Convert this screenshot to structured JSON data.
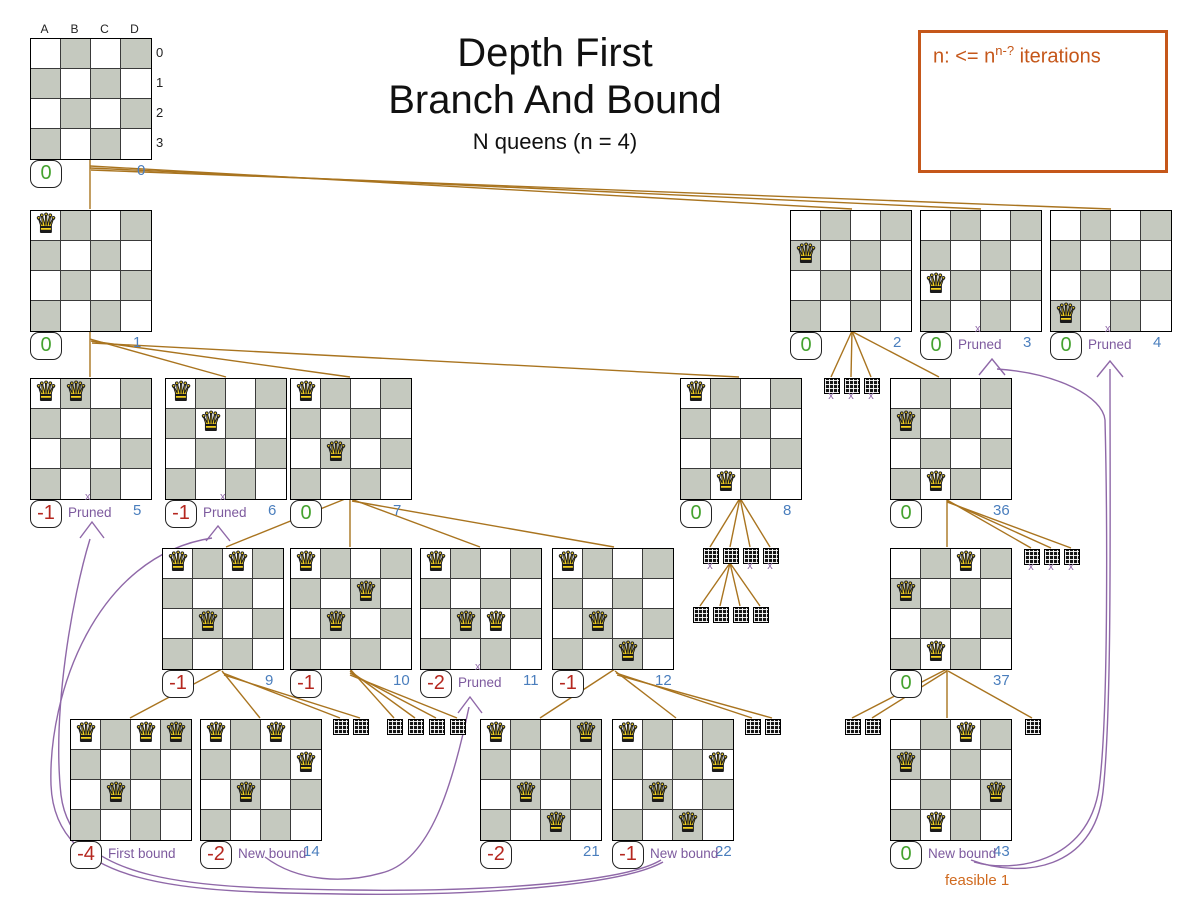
{
  "page": {
    "title_line1": "Depth First",
    "title_line2": "Branch And Bound",
    "subtitle": "N queens (n = 4)"
  },
  "note": {
    "prefix": "n: <= n",
    "superscript": "n-?",
    "suffix": " iterations"
  },
  "board_labels": {
    "columns": [
      "A",
      "B",
      "C",
      "D"
    ],
    "rows": [
      "0",
      "1",
      "2",
      "3"
    ]
  },
  "icons": {
    "queen_glyph": "♛",
    "prune_mark": "x"
  },
  "labels": {
    "pruned": "Pruned",
    "first_bound": "First bound",
    "new_bound": "New bound",
    "feasible": "feasible 1"
  },
  "colors": {
    "edge": "#a9741f",
    "purple": "#8f68a8",
    "label_purple": "#7d5a9e",
    "index_blue": "#4a7ebd",
    "score_green": "#44a22e",
    "score_red": "#b5271f",
    "orange": "#c5571a",
    "feasible_orange": "#d06a1f",
    "dark_cell": "#c5c9bf"
  },
  "nodes": [
    {
      "index": "0",
      "x": 30,
      "y": 38,
      "queens": [],
      "score": "0",
      "state": "good",
      "root": true,
      "index_offset": 107
    },
    {
      "index": "1",
      "x": 30,
      "y": 210,
      "queens": [
        [
          0,
          0
        ]
      ],
      "score": "0",
      "state": "good"
    },
    {
      "index": "2",
      "x": 790,
      "y": 210,
      "queens": [
        [
          0,
          1
        ]
      ],
      "score": "0",
      "state": "good"
    },
    {
      "index": "3",
      "x": 920,
      "y": 210,
      "queens": [
        [
          0,
          2
        ]
      ],
      "score": "0",
      "state": "good",
      "tag": "Pruned",
      "tag_x": true
    },
    {
      "index": "4",
      "x": 1050,
      "y": 210,
      "queens": [
        [
          0,
          3
        ]
      ],
      "score": "0",
      "state": "good",
      "tag": "Pruned",
      "tag_x": true
    },
    {
      "index": "5",
      "x": 30,
      "y": 378,
      "queens": [
        [
          0,
          0
        ],
        [
          1,
          0
        ]
      ],
      "score": "-1",
      "state": "bad",
      "tag": "Pruned",
      "tag_x": true
    },
    {
      "index": "6",
      "x": 165,
      "y": 378,
      "queens": [
        [
          0,
          0
        ],
        [
          1,
          1
        ]
      ],
      "score": "-1",
      "state": "bad",
      "tag": "Pruned",
      "tag_x": true
    },
    {
      "index": "7",
      "x": 290,
      "y": 378,
      "queens": [
        [
          0,
          0
        ],
        [
          1,
          2
        ]
      ],
      "score": "0",
      "state": "good"
    },
    {
      "index": "8",
      "x": 680,
      "y": 378,
      "queens": [
        [
          0,
          0
        ],
        [
          1,
          3
        ]
      ],
      "score": "0",
      "state": "good"
    },
    {
      "index": "36",
      "x": 890,
      "y": 378,
      "queens": [
        [
          0,
          1
        ],
        [
          1,
          3
        ]
      ],
      "score": "0",
      "state": "good"
    },
    {
      "index": "9",
      "x": 162,
      "y": 548,
      "queens": [
        [
          0,
          0
        ],
        [
          2,
          0
        ],
        [
          1,
          2
        ]
      ],
      "score": "-1",
      "state": "bad"
    },
    {
      "index": "10",
      "x": 290,
      "y": 548,
      "queens": [
        [
          0,
          0
        ],
        [
          2,
          1
        ],
        [
          1,
          2
        ]
      ],
      "score": "-1",
      "state": "bad"
    },
    {
      "index": "11",
      "x": 420,
      "y": 548,
      "queens": [
        [
          0,
          0
        ],
        [
          1,
          2
        ],
        [
          2,
          2
        ]
      ],
      "score": "-2",
      "state": "bad",
      "tag": "Pruned",
      "tag_x": true
    },
    {
      "index": "12",
      "x": 552,
      "y": 548,
      "queens": [
        [
          0,
          0
        ],
        [
          1,
          2
        ],
        [
          2,
          3
        ]
      ],
      "score": "-1",
      "state": "bad"
    },
    {
      "index": "37",
      "x": 890,
      "y": 548,
      "queens": [
        [
          2,
          0
        ],
        [
          0,
          1
        ],
        [
          1,
          3
        ]
      ],
      "score": "0",
      "state": "good"
    },
    {
      "index": "13",
      "x": 70,
      "y": 719,
      "queens": [
        [
          0,
          0
        ],
        [
          2,
          0
        ],
        [
          3,
          0
        ],
        [
          1,
          2
        ]
      ],
      "score": "-4",
      "state": "bad",
      "tag": "First bound",
      "index_offset": 135
    },
    {
      "index": "14",
      "x": 200,
      "y": 719,
      "queens": [
        [
          0,
          0
        ],
        [
          2,
          0
        ],
        [
          3,
          1
        ],
        [
          1,
          2
        ]
      ],
      "score": "-2",
      "state": "bad",
      "tag": "New bound"
    },
    {
      "index": "21",
      "x": 480,
      "y": 719,
      "queens": [
        [
          0,
          0
        ],
        [
          3,
          0
        ],
        [
          1,
          2
        ],
        [
          2,
          3
        ]
      ],
      "score": "-2",
      "state": "bad"
    },
    {
      "index": "22",
      "x": 612,
      "y": 719,
      "queens": [
        [
          0,
          0
        ],
        [
          3,
          1
        ],
        [
          1,
          2
        ],
        [
          2,
          3
        ]
      ],
      "score": "-1",
      "state": "bad",
      "tag": "New bound"
    },
    {
      "index": "43",
      "x": 890,
      "y": 719,
      "queens": [
        [
          2,
          0
        ],
        [
          0,
          1
        ],
        [
          3,
          2
        ],
        [
          1,
          3
        ]
      ],
      "score": "0",
      "state": "good",
      "tag": "New bound",
      "tag2": "feasible 1"
    }
  ],
  "mini_nodes": [
    {
      "x": 824,
      "y": 378,
      "x_mark": true
    },
    {
      "x": 844,
      "y": 378,
      "x_mark": true
    },
    {
      "x": 864,
      "y": 378,
      "x_mark": true
    },
    {
      "x": 703,
      "y": 548,
      "x_mark": true
    },
    {
      "x": 723,
      "y": 548,
      "x_mark": false
    },
    {
      "x": 743,
      "y": 548,
      "x_mark": true
    },
    {
      "x": 763,
      "y": 548,
      "x_mark": true
    },
    {
      "x": 693,
      "y": 607,
      "x_mark": false
    },
    {
      "x": 713,
      "y": 607,
      "x_mark": false
    },
    {
      "x": 733,
      "y": 607,
      "x_mark": false
    },
    {
      "x": 753,
      "y": 607,
      "x_mark": false
    },
    {
      "x": 1024,
      "y": 549,
      "x_mark": true
    },
    {
      "x": 1044,
      "y": 549,
      "x_mark": true
    },
    {
      "x": 1064,
      "y": 549,
      "x_mark": true
    },
    {
      "x": 333,
      "y": 719,
      "x_mark": false
    },
    {
      "x": 353,
      "y": 719,
      "x_mark": false
    },
    {
      "x": 387,
      "y": 719,
      "x_mark": false
    },
    {
      "x": 408,
      "y": 719,
      "x_mark": false
    },
    {
      "x": 429,
      "y": 719,
      "x_mark": false
    },
    {
      "x": 450,
      "y": 719,
      "x_mark": false
    },
    {
      "x": 745,
      "y": 719,
      "x_mark": false
    },
    {
      "x": 765,
      "y": 719,
      "x_mark": false
    },
    {
      "x": 845,
      "y": 719,
      "x_mark": false
    },
    {
      "x": 865,
      "y": 719,
      "x_mark": false
    },
    {
      "x": 1025,
      "y": 719,
      "x_mark": false
    }
  ]
}
